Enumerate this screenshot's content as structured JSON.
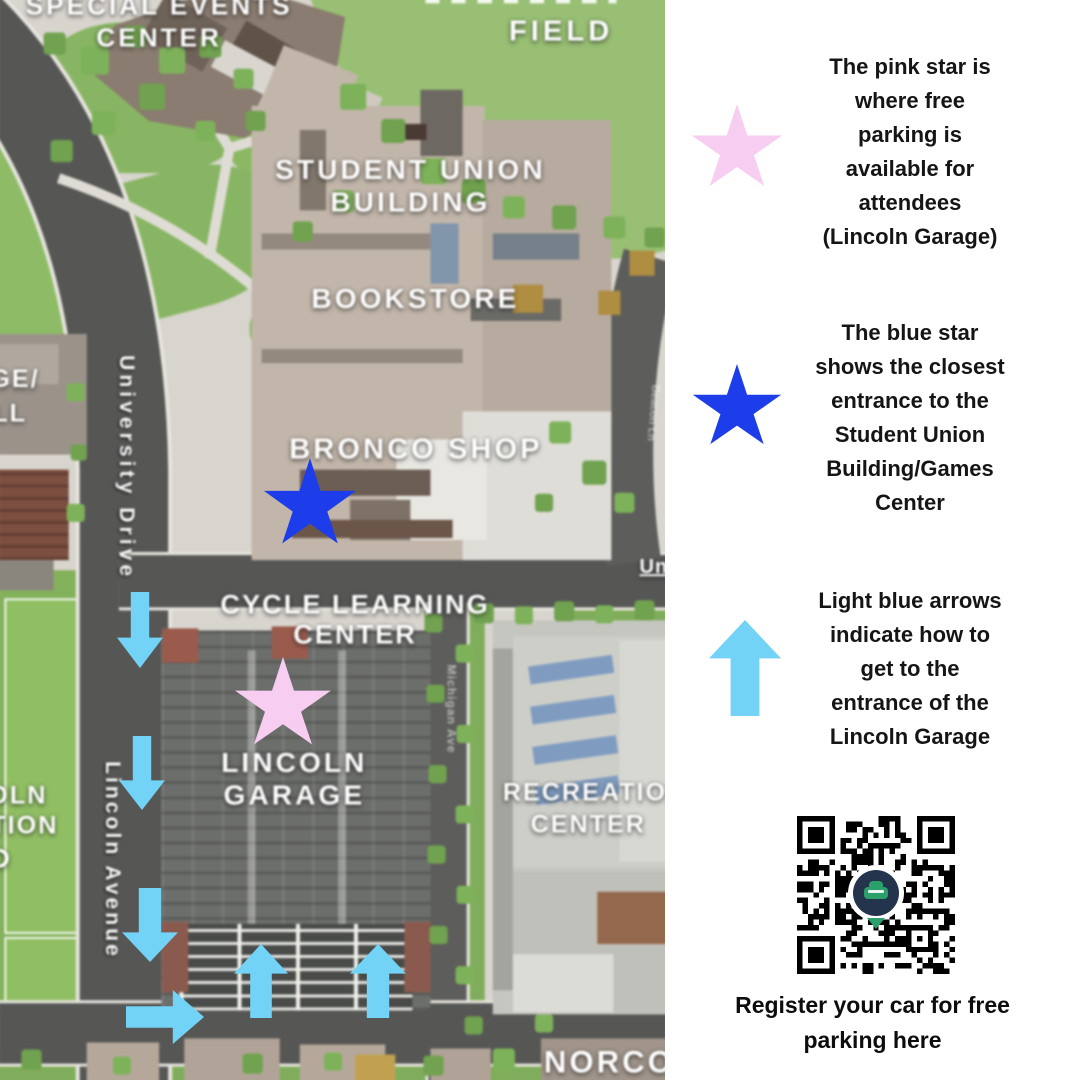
{
  "panel": {
    "legend": [
      {
        "icon": "pink-star",
        "color": "#f7cdf2",
        "text": "The pink star is\nwhere free\nparking is\navailable for\nattendees\n(Lincoln Garage)"
      },
      {
        "icon": "blue-star",
        "color": "#1d3deb",
        "text": "The blue star\nshows the closest\nentrance to the\nStudent Union\nBuilding/Games\nCenter"
      },
      {
        "icon": "light-blue-arrow",
        "color": "#72d3f6",
        "text": "Light blue arrows\nindicate how to\nget to the\nentrance of the\nLincoln Garage"
      }
    ],
    "qr_caption": "Register your car for free\nparking here"
  },
  "map": {
    "buildings": {
      "special_events_center": "SPECIAL EVENTS\nCENTER",
      "field": "FIELD",
      "student_union_building": "STUDENT UNION\nBUILDING",
      "bookstore": "BOOKSTORE",
      "bronco_shop": "BRONCO SHOP",
      "cycle_learning_center": "CYCLE LEARNING\nCENTER",
      "lincoln_garage": "LINCOLN\nGARAGE",
      "recreation_center_line1": "RECREATION",
      "recreation_center_line2": "CENTER",
      "norco": "NORCO"
    },
    "partial_labels": {
      "left_ge": "GE/",
      "left_ll": "LL",
      "left_oln": "OLN",
      "left_tion": "TION",
      "left_d": "D",
      "right_un": "Un"
    },
    "streets": {
      "university_drive": "University Drive",
      "lincoln_avenue": "Lincoln Avenue",
      "michigan_ave": "Michigan Ave",
      "beacon_ln": "Beacon Ln"
    },
    "markers": {
      "pink_star_color": "#f7cdf2",
      "blue_star_color": "#1d3deb",
      "arrow_color": "#72d3f6"
    }
  }
}
